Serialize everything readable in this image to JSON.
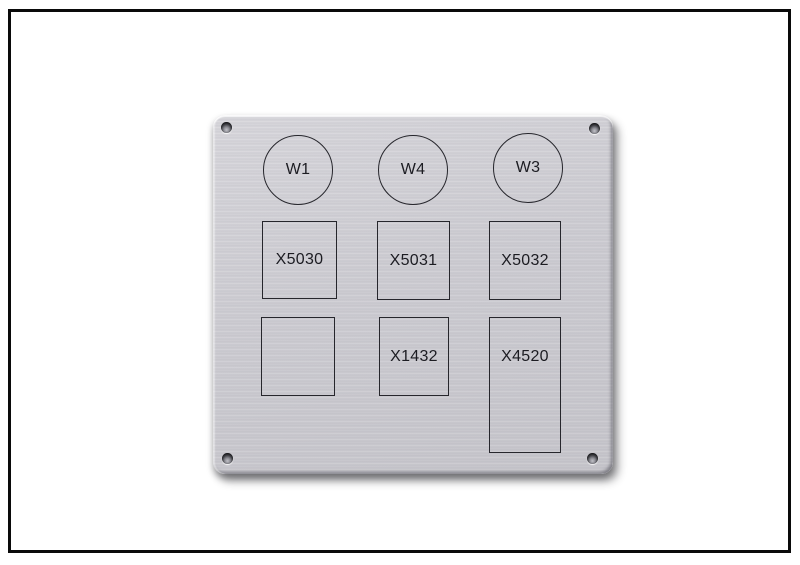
{
  "plate": {
    "circles": [
      {
        "label": "W1"
      },
      {
        "label": "W4"
      },
      {
        "label": "W3"
      }
    ],
    "squares_row": [
      {
        "label": "X5030"
      },
      {
        "label": "X5031"
      },
      {
        "label": "X5032"
      }
    ],
    "bottom_row": [
      {
        "label": ""
      },
      {
        "label": "X1432"
      },
      {
        "label": "X4520"
      }
    ]
  },
  "colors": {
    "background": "#ffffff",
    "frame_border": "#0a0a0a",
    "plate_base": "#cccbd1",
    "plate_highlight": "#d7d6db",
    "plate_edge_dark": "#77777e",
    "outline": "#26262c",
    "text": "#1c1c22",
    "screw_hole_dark": "#2c2c31",
    "drop_shadow": "rgba(30,30,35,0.45)"
  }
}
